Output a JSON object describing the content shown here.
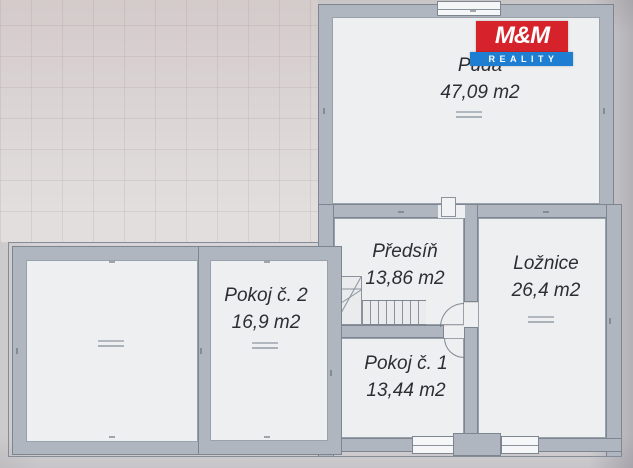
{
  "document": {
    "type": "floor-plan-photo",
    "language": "cs"
  },
  "logo": {
    "brand": "M&M",
    "subtitle": "REALITY",
    "brand_bg": "#d6232b",
    "subtitle_bg": "#1d7ed2",
    "text_color": "#ffffff"
  },
  "rooms": [
    {
      "id": "puda",
      "name": "Půda",
      "area": "47,09 m2"
    },
    {
      "id": "predsin",
      "name": "Předsíň",
      "area": "13,86 m2"
    },
    {
      "id": "loznice",
      "name": "Ložnice",
      "area": "26,4 m2"
    },
    {
      "id": "pokoj2",
      "name": "Pokoj č. 2",
      "area": "16,9 m2"
    },
    {
      "id": "pokoj1",
      "name": "Pokoj č. 1",
      "area": "13,44 m2"
    }
  ],
  "colors": {
    "wall_fill": "#b0b6bf",
    "wall_outline": "#7d8690",
    "floor_fill": "#edeff1",
    "paper_bg": "#d6d4d6",
    "label_text": "#2d2d33"
  }
}
